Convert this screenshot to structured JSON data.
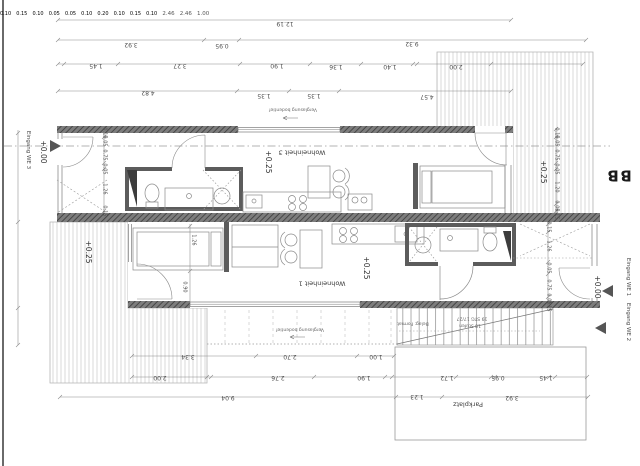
{
  "labels": {
    "eingang_we3": "Eingang WE 3",
    "eingang_we2": "Eingang WE 2",
    "eingang_we1": "Eingang WE 1",
    "wohneinheit3": "Wohneinheit 3",
    "wohneinheit1": "Wohneinheit 1",
    "verglasung": "Verglasung bodentief",
    "verglasung2": "Verglasung bodentief",
    "stair_note_line1": "19 STG 17/27",
    "stair_note_line2": "18 Stufen",
    "belag_note": "Belag: Format",
    "parkplatz": "Parkplatz",
    "section_marker": "B",
    "section_marker2": "B"
  },
  "levels": {
    "zero_left": "+0.00",
    "zero_right": "+0.00",
    "unit3": "+0.25",
    "unit1": "+0.25",
    "deck_left": "+0.25",
    "terrace_right": "+0.25"
  },
  "dims": {
    "rowA": [
      "12.19"
    ],
    "rowB": [
      "3.92",
      "0.95",
      "9.32"
    ],
    "rowC": [
      "0.10",
      "0.15",
      "1.45",
      "3.27",
      "1.90",
      "1.36",
      "1.40",
      "0.10",
      "2.00"
    ],
    "rowD": [
      "4.82",
      "0.05",
      "1.35",
      "1.35",
      "0.05",
      "4.57"
    ],
    "rowE": [
      "3.34",
      "2.70",
      "1.00"
    ],
    "rowF": [
      "2.00",
      "0.10",
      "2.76",
      "1.90",
      "0.20",
      "1.72",
      "0.95",
      "0.10",
      "1.45",
      "0.15",
      "0.10"
    ],
    "rowG": [
      "9.04",
      "1.23",
      "3.92"
    ],
    "colLeft": [
      "2.46",
      "2.46",
      "1.00"
    ],
    "chainUpperLeft": [
      "0.15",
      "0.05",
      "0.75",
      "0.05",
      "1.26",
      "0.15"
    ],
    "chainTerrace": [
      "0.15",
      "0.05",
      "0.75",
      "0.05",
      "1.20",
      "0.05",
      "0.15"
    ],
    "chainLowerRight": [
      "0.15",
      "1.26",
      "0.05",
      "0.75",
      "0.05",
      "0.15"
    ],
    "chainInterior": [
      "1.26",
      "0.90"
    ]
  }
}
